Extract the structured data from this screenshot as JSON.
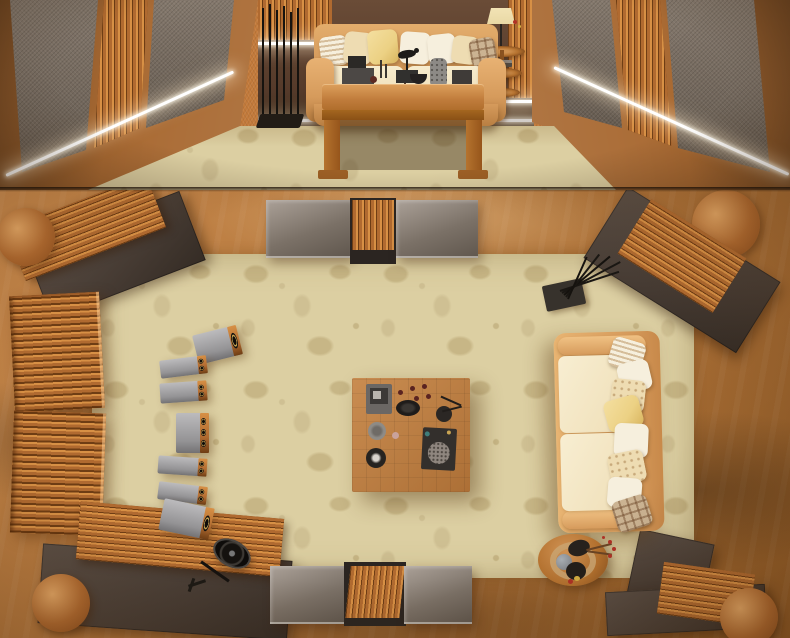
{
  "meta": {
    "description": "3D rendering of a hi-fi living room shown twice: a front elevation view on the top strip and a top-down floor-plan view below.",
    "views": [
      "front elevation view",
      "top-down plan view"
    ]
  },
  "palette": {
    "floor": "#b0743a",
    "carpet": "#dccfa2",
    "carpetMotif": "#c7b686",
    "carpetMotif2": "#cfc093",
    "copperWall": "#a96a33",
    "fabric": "#7a6d60",
    "panelDark": "#4e433b",
    "slat": "#b06a30",
    "slatLight": "#d79045",
    "slatDark": "#6e3d14",
    "backWall": "#5d4331",
    "led": "#ffffff",
    "leather": "#d69b5c",
    "leatherDark": "#b97f42",
    "cushion": "#f1e2bd",
    "pillowWhite": "#f6efdd",
    "pillowCream": "#eedcb2",
    "pillowYellow": "#ecd184",
    "pillowPlaid": "#cbb392",
    "wood": "#c07c3c",
    "woodDark": "#9c5f25",
    "woodSide": "#b5722f",
    "objDark": "#2e2a27",
    "objGray": "#8d8a86",
    "shade": "#e9d8a5",
    "red": "#b03226"
  },
  "front_view": {
    "label": "Front elevation view",
    "objects": {
      "left_wall": "Copper wall with fabric acoustic panels and copper slat diffuser",
      "right_wall": "Copper wall with fabric acoustic panels and copper slat diffuser",
      "back_wall": "Dark brown back wall with wooden slat columns and LED cove lighting",
      "led": "White LED light strip",
      "carpet": "Beige floral area carpet",
      "sofa": "Tan leather sofa with cream seat cushions and assorted pillows",
      "pillows": [
        "striped",
        "cream",
        "yellow",
        "white",
        "white",
        "cream",
        "plaid"
      ],
      "rack": "Black metal rod floor stand",
      "side_table": "Three-tier round wooden side table with lamp, vase, flowers and books",
      "coffee_table": "Low wooden coffee table with decor objects",
      "decor": [
        "black bird sculpture",
        "textured gray vase",
        "dark boxes",
        "black bowl",
        "candlesticks",
        "red cup"
      ]
    }
  },
  "plan_view": {
    "label": "Top-down plan view",
    "objects": {
      "floor": "Copper-orange floor with fabric-like folds",
      "carpet": "Beige floral area carpet",
      "panel_top": "Gray acoustic panels with central copper slat diffuser (top wall)",
      "panel_bottom": "Gray acoustic panels with central copper slat diffuser (bottom wall)",
      "corner_panels": "Dark corner panels with fanned copper slats and rounded copper caps",
      "diffusers": "Two copper slat diffuser blocks on the left wall",
      "speakers": "Row of seven gray loudspeakers with copper baffles and a center channel",
      "coffee_table": "Square parquet-top coffee table with decor objects",
      "sofa": "Cream leather sofa with eight assorted pillows",
      "side_table": "Round tiered wooden side table with stones and a red flower sprig",
      "fan": "Black pedestal fan lying on the carpet",
      "coat_stand": "Dark floor mat with splayed black rods"
    }
  }
}
